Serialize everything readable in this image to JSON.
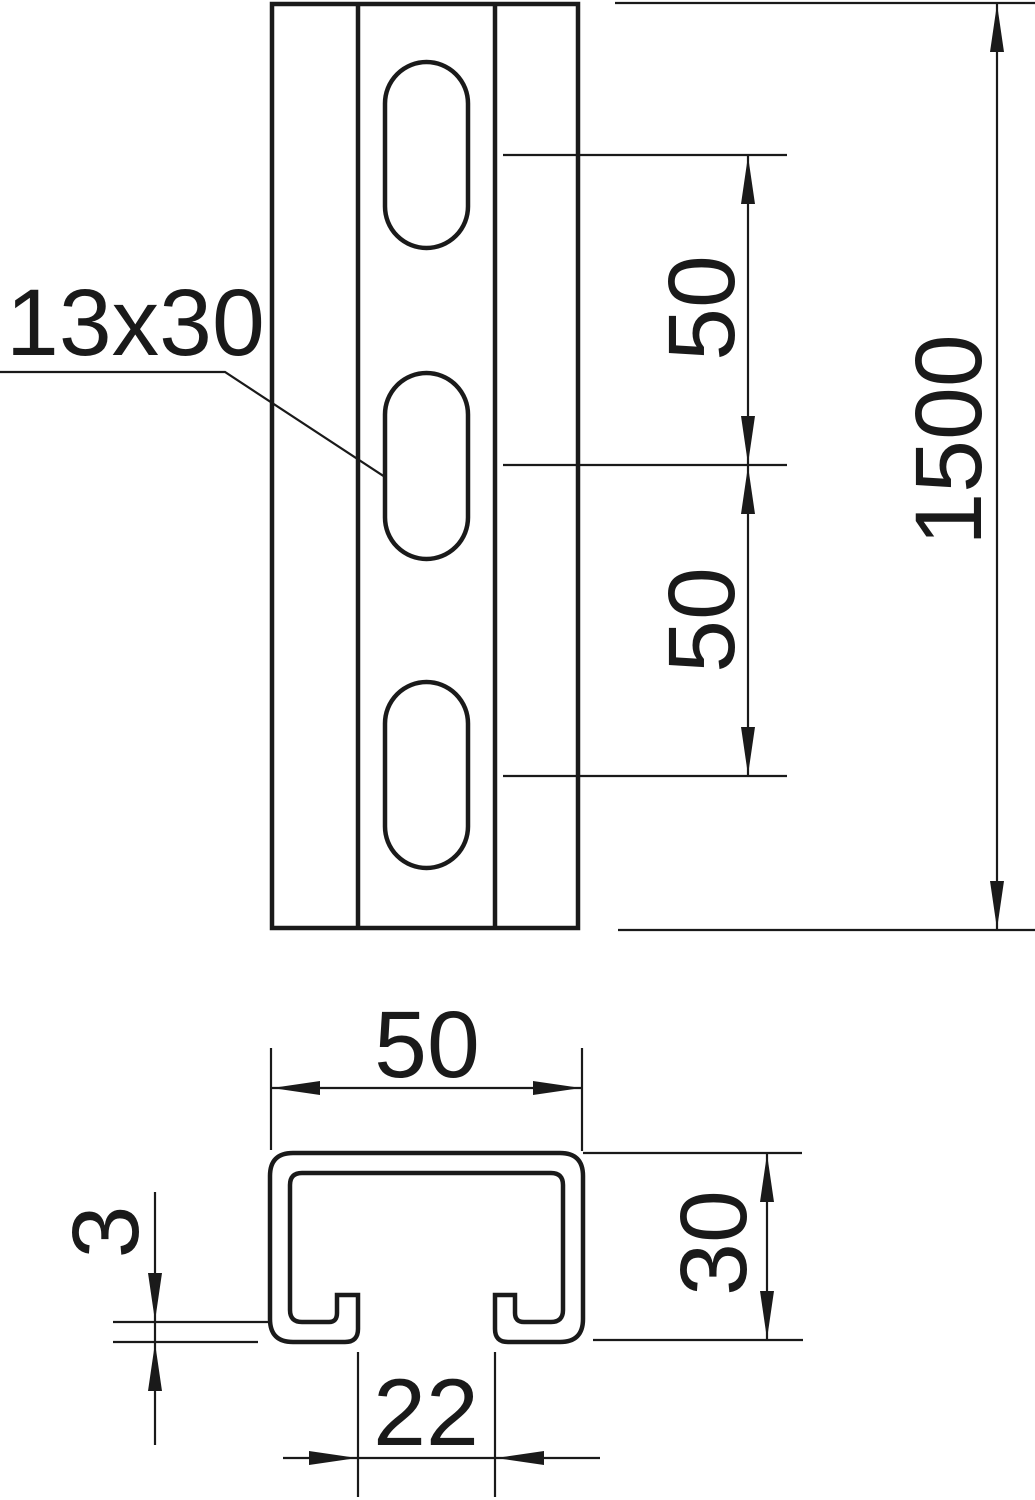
{
  "front_view": {
    "slot_size_label": "13x30",
    "hole_pitch_upper": "50",
    "hole_pitch_lower": "50",
    "total_length": "1500"
  },
  "cross_section": {
    "width": "50",
    "height": "30",
    "material_thickness": "3",
    "slot_opening": "22"
  },
  "colors": {
    "line": "#1a1a1a",
    "background": "#ffffff"
  }
}
